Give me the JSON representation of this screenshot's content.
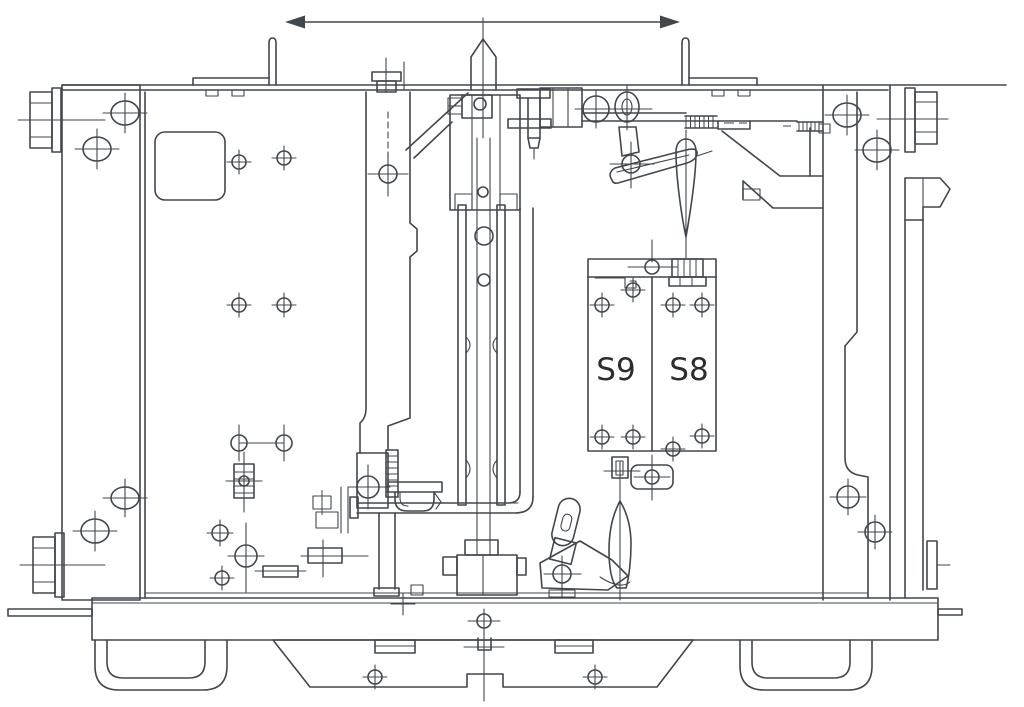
{
  "diagram": {
    "labels": {
      "switch_left": "S9",
      "switch_right": "S8"
    },
    "colors": {
      "line": "#42474c",
      "label_text": "#2b2d2f",
      "background": "#ffffff"
    },
    "components": [
      "dimension-arrow",
      "top-rail",
      "left-angle-bracket",
      "right-angle-bracket",
      "left-side-panel",
      "left-guide-wheel-top",
      "left-guide-wheel-bottom",
      "nameplate-rounded-square",
      "interlock-pin",
      "center-guide-column",
      "spring-plate",
      "operating-rod",
      "auxiliary-switch-box",
      "upper-linkage",
      "drive-teardrop-link",
      "lower-linkage",
      "right-side-panel",
      "right-guide-wheel",
      "latch-pointer",
      "base-rail",
      "left-skid",
      "right-skid",
      "bottom-trapezoid-plate"
    ]
  }
}
